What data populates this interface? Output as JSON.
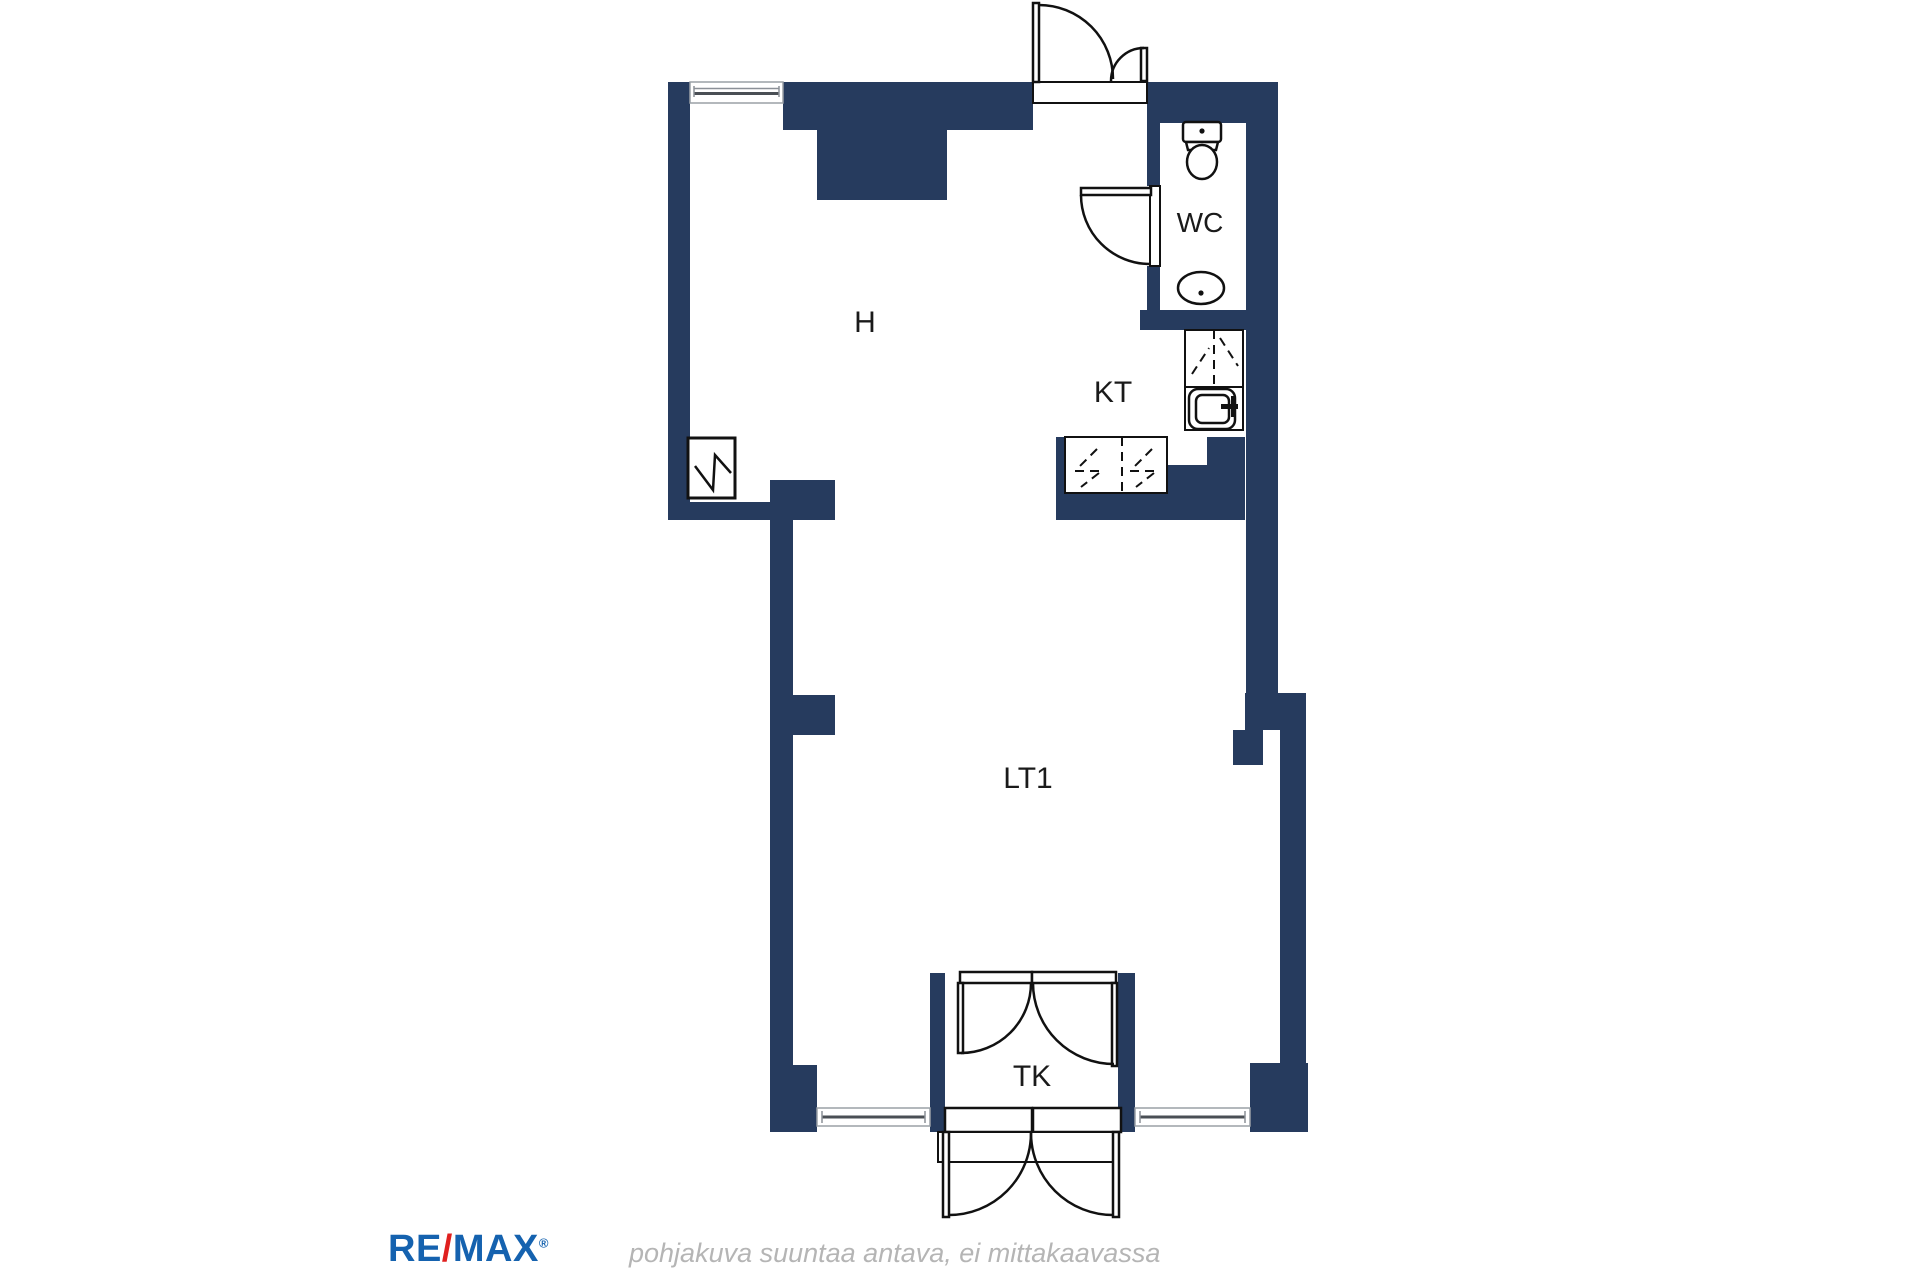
{
  "plan": {
    "wall_color": "#263b5e",
    "outline_color": "#111111",
    "labels": {
      "hall": "H",
      "wc": "WC",
      "kitchen": "KT",
      "main_room": "LT1",
      "vestibule": "TK"
    },
    "fixtures": [
      "toilet-icon",
      "washbasin-icon",
      "kitchen-sink-icon",
      "flue-icon",
      "kitchen-cabinets-dashed",
      "window-symbols",
      "door-swing-symbols"
    ]
  },
  "footer": {
    "logo": {
      "re": "RE",
      "slash": "/",
      "max": "MAX",
      "registered": "®",
      "blue": "#1562af",
      "red": "#e0201f"
    },
    "disclaimer": "pohjakuva suuntaa antava, ei mittakaavassa",
    "disclaimer_color": "#b5b5b5"
  }
}
